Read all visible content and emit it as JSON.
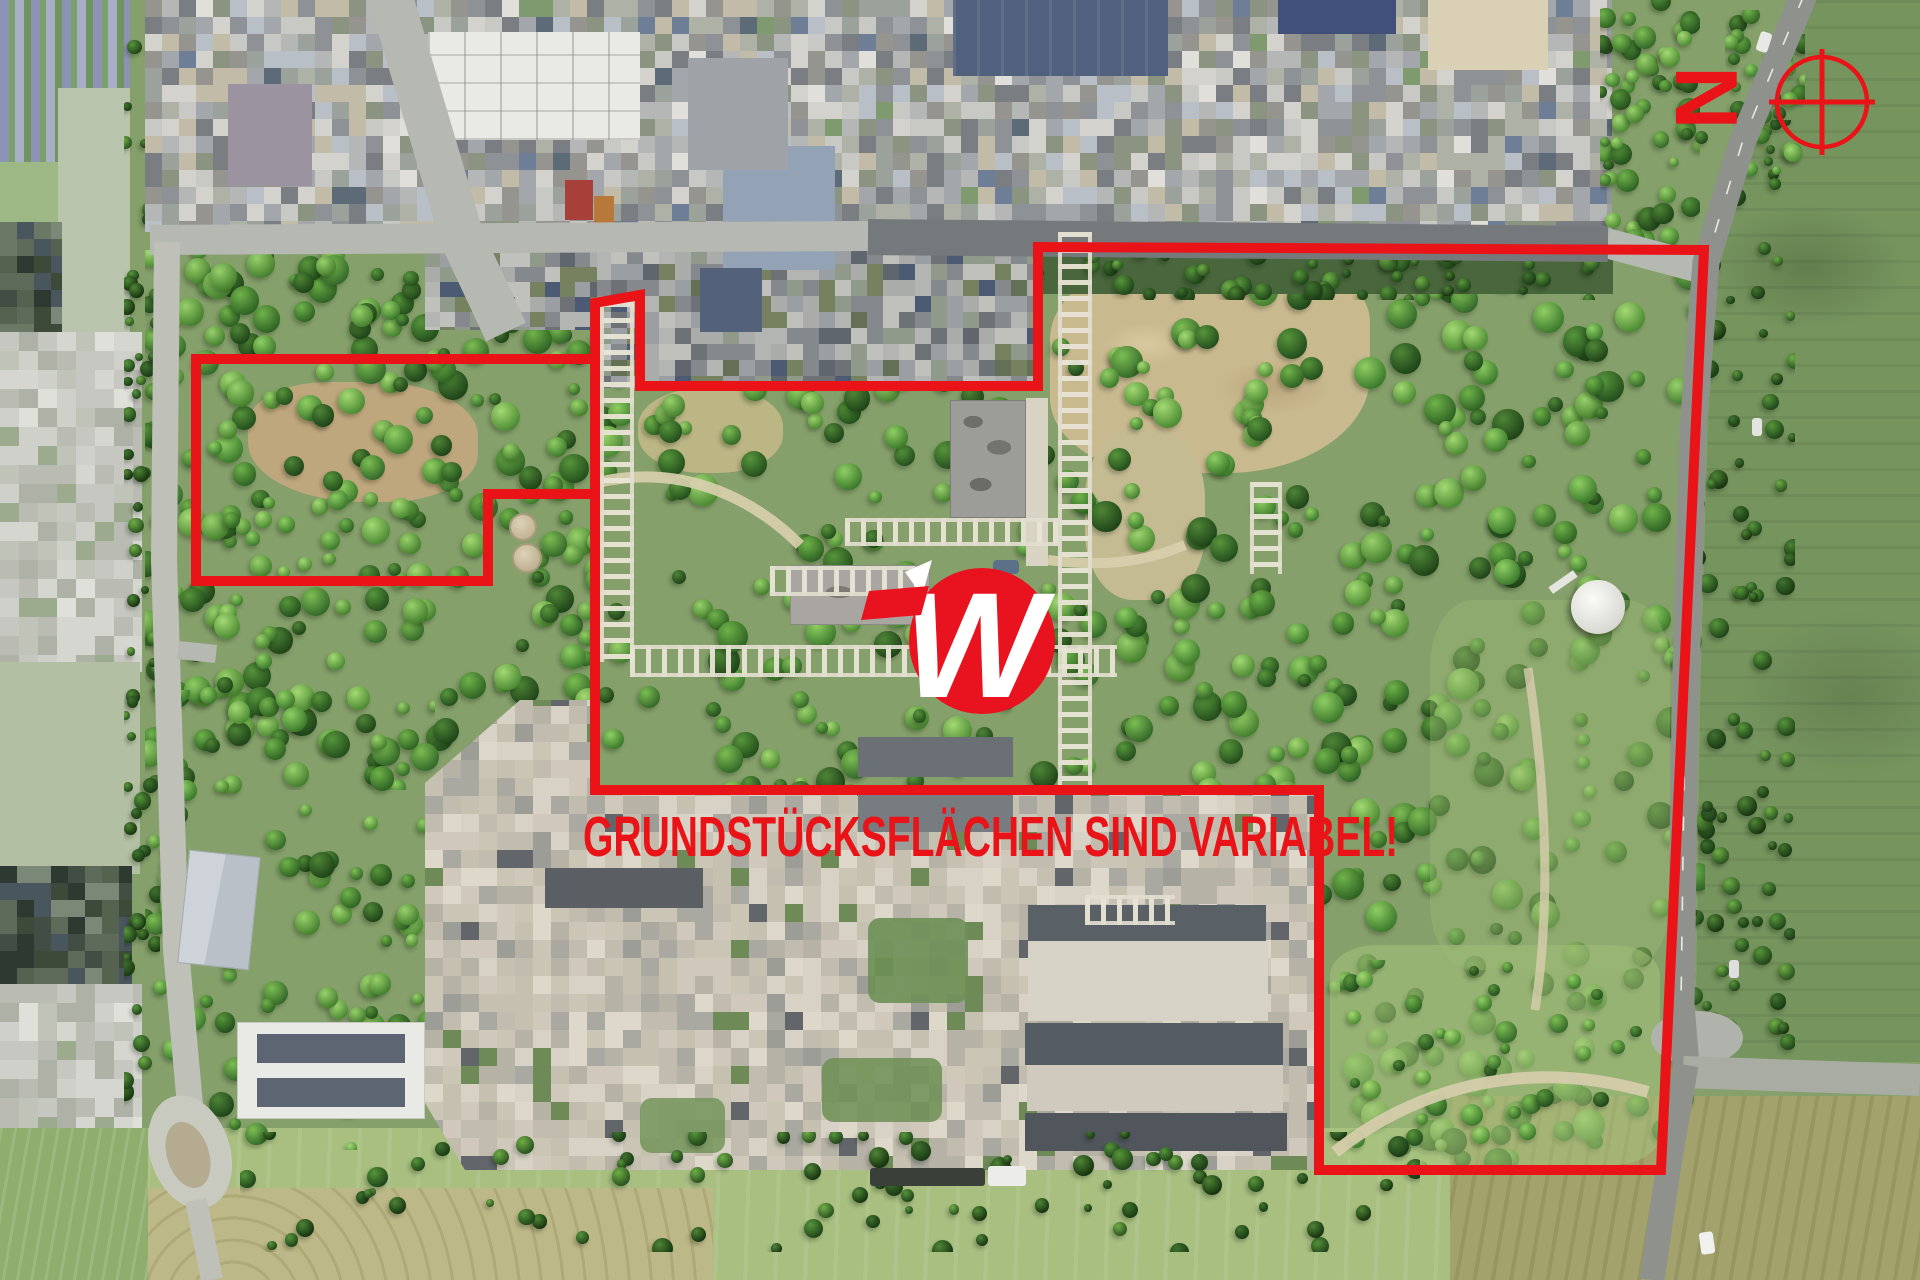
{
  "overlay": {
    "headline": "GRUNDSTÜCKSFLÄCHEN SIND VARIABEL!",
    "north_letter": "N",
    "accent_color": "#ea1318",
    "logo": {
      "letter": "W",
      "color": "#e8131f"
    }
  }
}
